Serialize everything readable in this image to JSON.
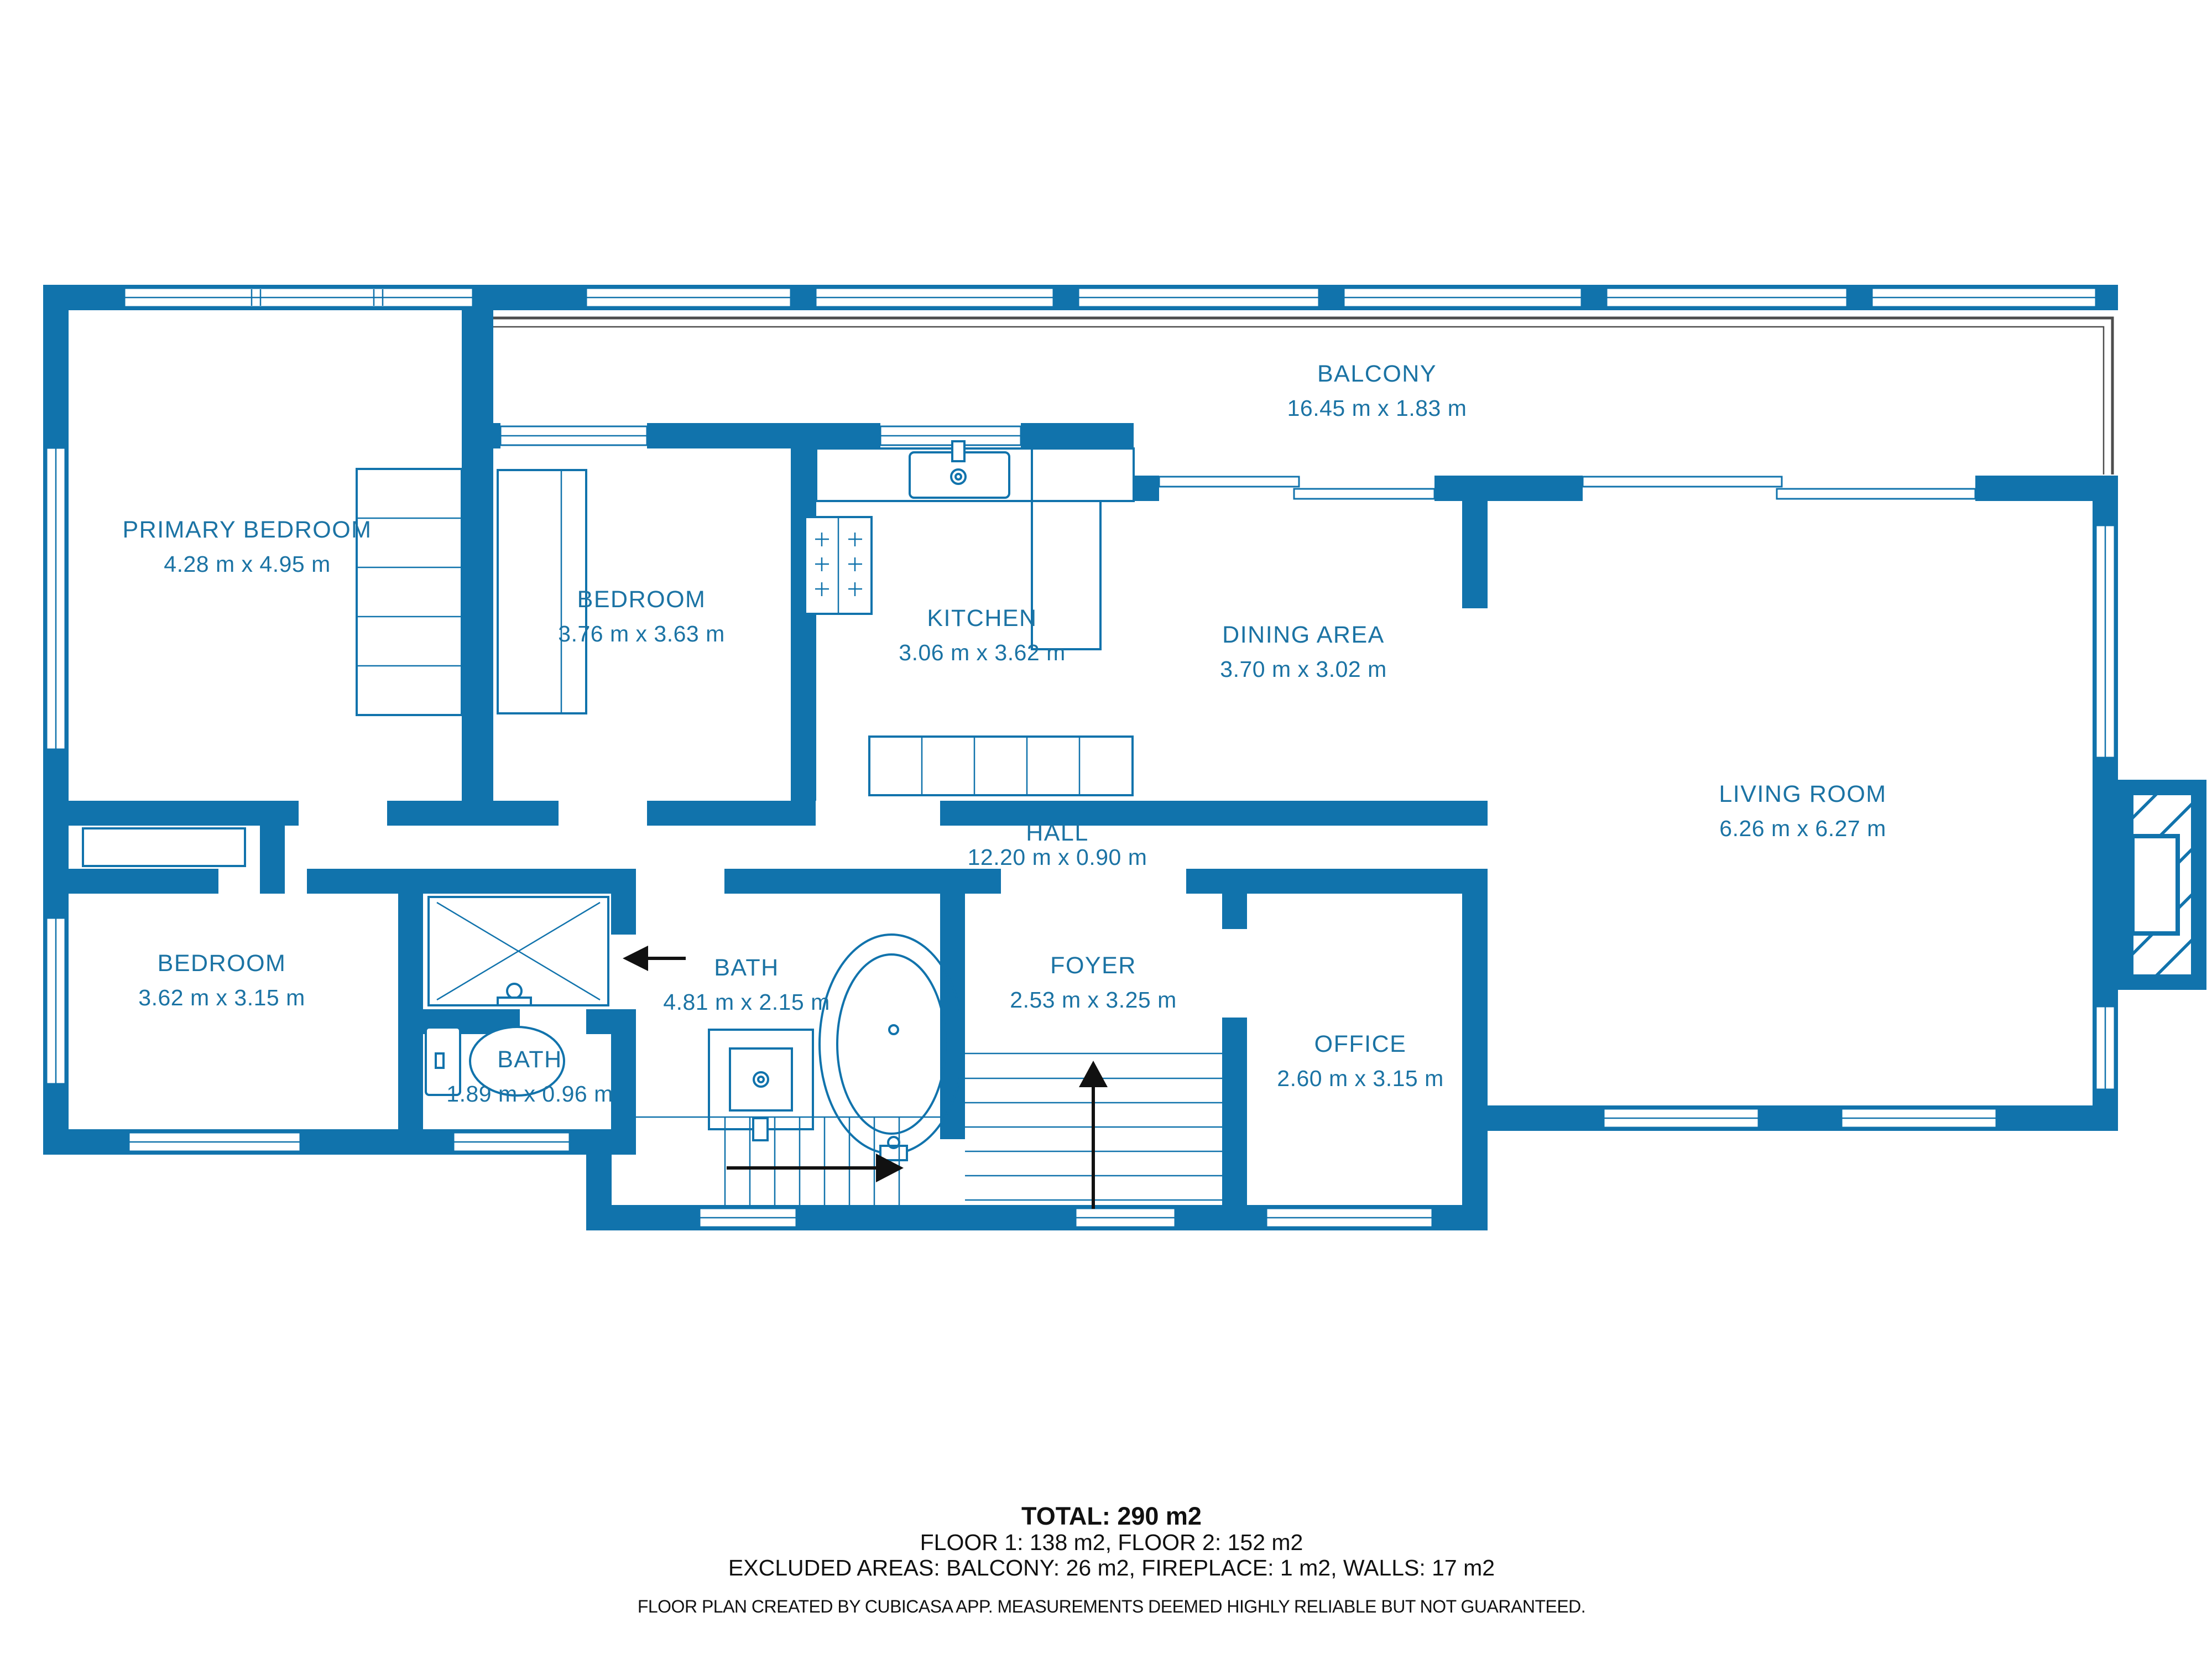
{
  "plan": {
    "colors": {
      "wall": "#1173ac",
      "label": "#1b73a4",
      "ink": "#111111",
      "rail": "#4d4d4d",
      "background": "#ffffff"
    },
    "rooms": [
      {
        "id": "balcony",
        "name": "BALCONY",
        "dims": "16.45 m x 1.83 m"
      },
      {
        "id": "primary-bedroom",
        "name": "PRIMARY BEDROOM",
        "dims": "4.28 m x 4.95 m"
      },
      {
        "id": "bedroom-upper",
        "name": "BEDROOM",
        "dims": "3.76 m x 3.63 m"
      },
      {
        "id": "kitchen",
        "name": "KITCHEN",
        "dims": "3.06 m x 3.62 m"
      },
      {
        "id": "dining-area",
        "name": "DINING AREA",
        "dims": "3.70 m x 3.02 m"
      },
      {
        "id": "living-room",
        "name": "LIVING ROOM",
        "dims": "6.26 m x 6.27 m"
      },
      {
        "id": "hall",
        "name": "HALL",
        "dims": "12.20 m x 0.90 m"
      },
      {
        "id": "bedroom-lower",
        "name": "BEDROOM",
        "dims": "3.62 m x 3.15 m"
      },
      {
        "id": "bath-main",
        "name": "BATH",
        "dims": "4.81 m x 2.15 m"
      },
      {
        "id": "bath-small",
        "name": "BATH",
        "dims": "1.89 m x 0.96 m"
      },
      {
        "id": "foyer",
        "name": "FOYER",
        "dims": "2.53 m x 3.25 m"
      },
      {
        "id": "office",
        "name": "OFFICE",
        "dims": "2.60 m x 3.15 m"
      }
    ],
    "summary": {
      "total": "TOTAL: 290 m2",
      "floors": "FLOOR 1: 138 m2, FLOOR 2: 152 m2",
      "excluded": "EXCLUDED AREAS: BALCONY: 26 m2, FIREPLACE: 1 m2, WALLS: 17 m2",
      "disclaimer": "FLOOR PLAN CREATED BY CUBICASA APP. MEASUREMENTS DEEMED HIGHLY RELIABLE BUT NOT GUARANTEED."
    }
  }
}
